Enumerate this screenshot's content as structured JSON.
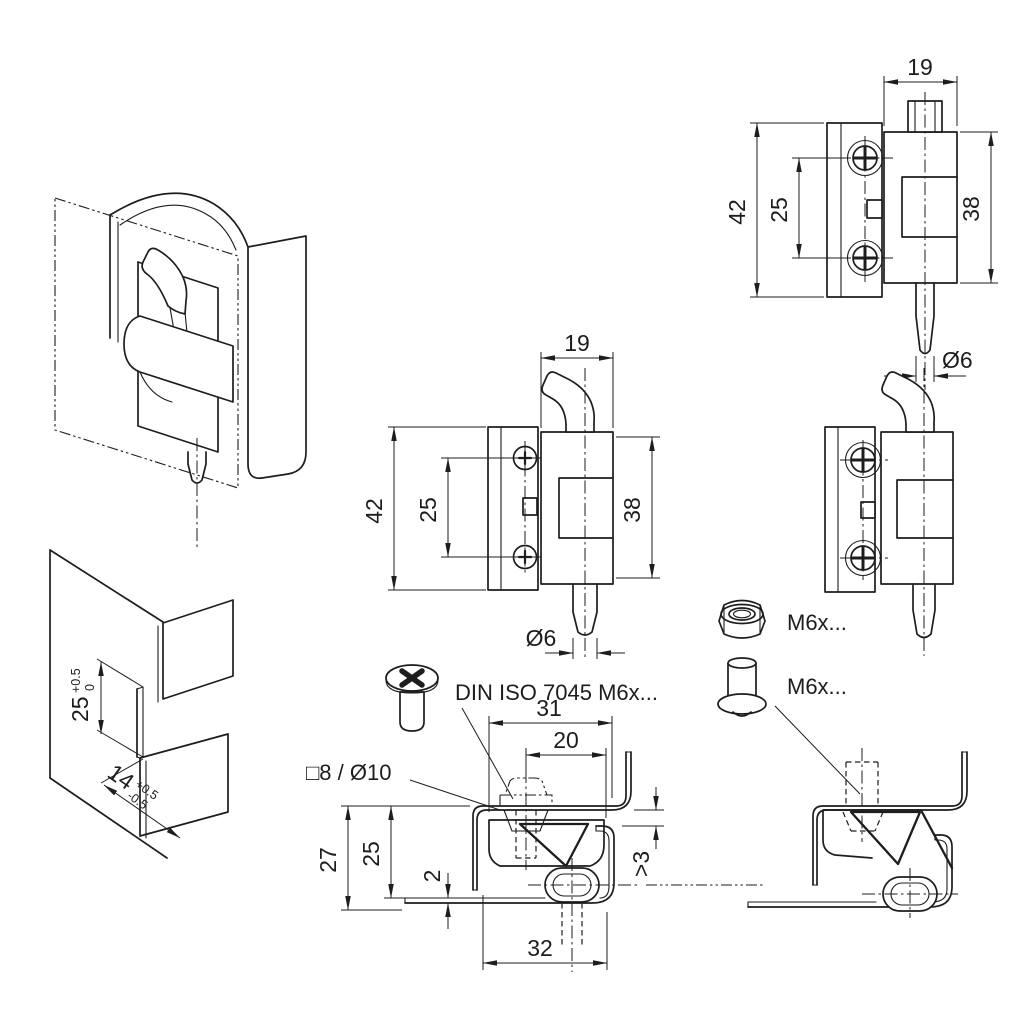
{
  "views": {
    "front_pin_up": {
      "dims": {
        "width": "19",
        "height": "42",
        "hole_spacing": "25",
        "leaf_height": "38",
        "pin_dia": "Ø6"
      }
    },
    "front_hook": {
      "dims": {
        "width": "19",
        "height": "42",
        "hole_spacing": "25",
        "leaf_height": "38",
        "pin_dia": "Ø6"
      }
    },
    "section_closed": {
      "dims": {
        "top_width": "31",
        "screw_offset": "20",
        "overall_height": "27",
        "offset_height": "25",
        "sheet_thickness": "2",
        "gap": ">3",
        "bottom_width": "32"
      }
    },
    "iso_bracket": {
      "dims": {
        "cutout_height": "25",
        "cutout_tol_upper": "+0.5",
        "cutout_tol_lower": "0",
        "flange_offset": "14",
        "flange_tol_upper": "+0.5",
        "flange_tol_lower": "-0.5"
      }
    }
  },
  "labels": {
    "screw_spec": "DIN ISO 7045 M6x...",
    "hole_spec": "□8 / Ø10",
    "nut_spec": "M6x...",
    "pin_spec": "M6x..."
  },
  "icons": {
    "screw": "phillips-pan-head-screw-icon",
    "nut": "hex-lock-nut-icon",
    "pin": "shoulder-pin-icon"
  }
}
